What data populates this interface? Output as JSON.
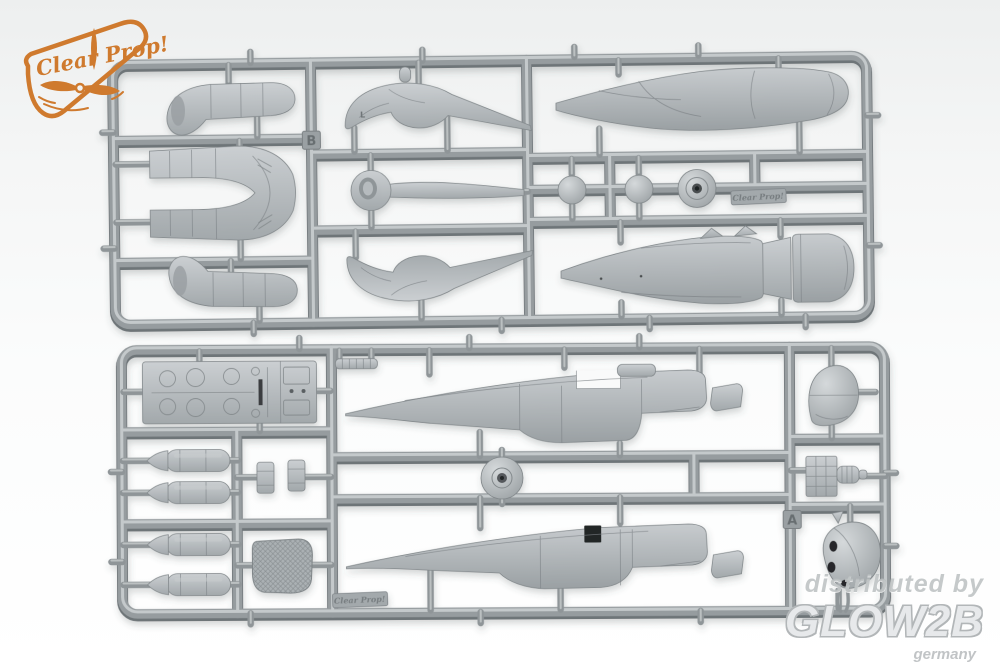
{
  "brand_logo": {
    "text": "Clear Prop!",
    "color": "#cf7a2e"
  },
  "watermark": {
    "line1": "distributed by",
    "line2": "GLOW2B",
    "line3": "germany"
  },
  "sprues": {
    "b": {
      "letter": "B",
      "nameplate": "Clear Prop!"
    },
    "a": {
      "letter": "A",
      "nameplate": "Clear Prop!"
    }
  },
  "part_marks": {
    "left": "L"
  },
  "colors": {
    "background": "#f4f5f5",
    "plastic_base": "#969c9f",
    "plastic_highlight": "#cdd1d3",
    "plastic_shadow": "#6e7478",
    "logo_orange": "#cf7a2e",
    "watermark_gray": "#bfc3c5"
  }
}
